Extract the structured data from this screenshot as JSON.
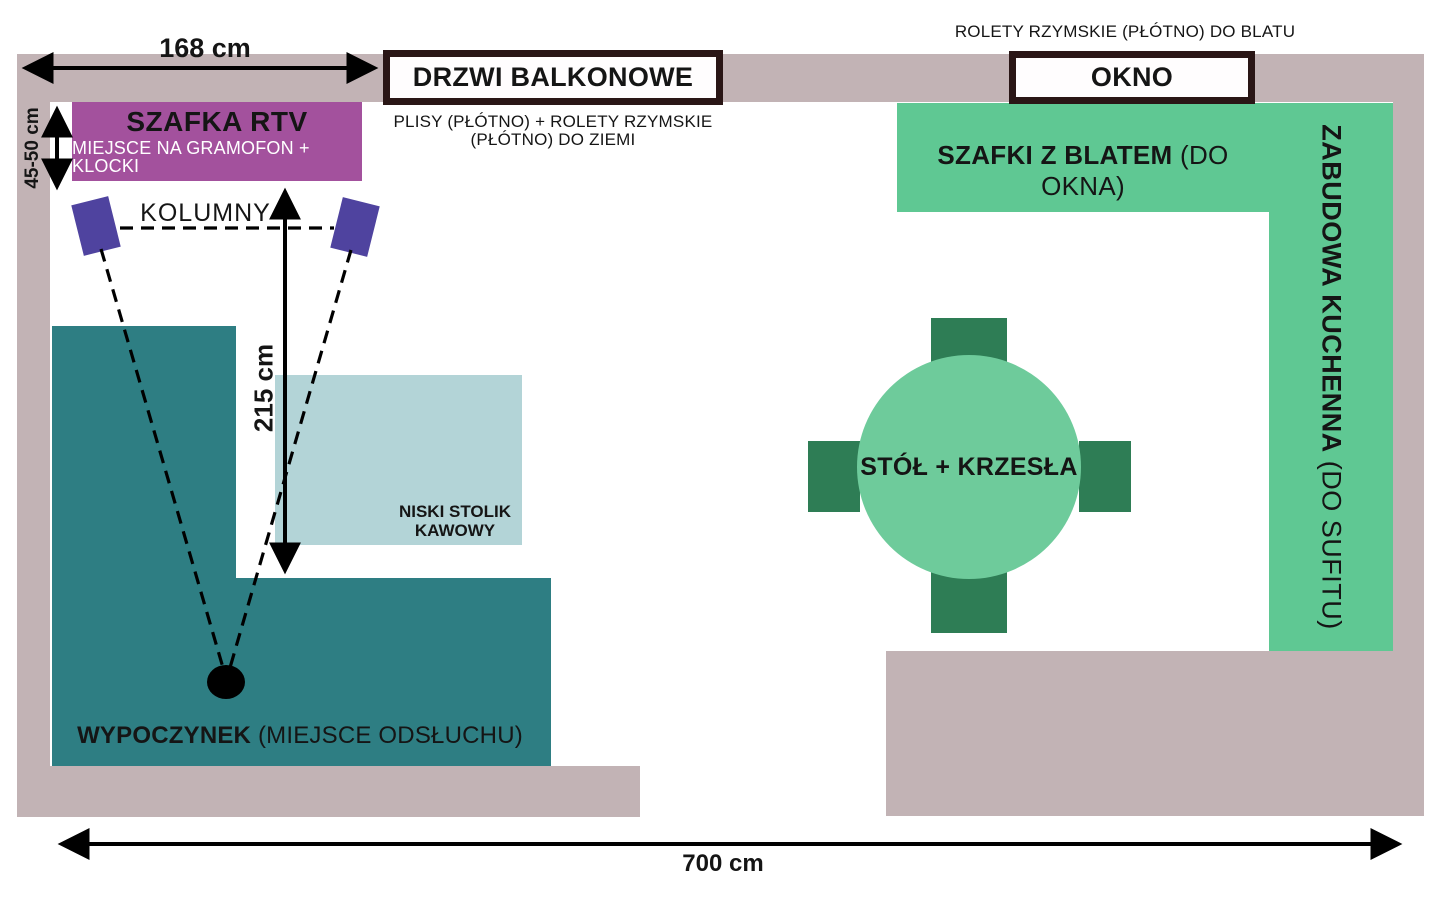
{
  "dimensions": {
    "top_width": "168 cm",
    "rtv_depth": "45-50 cm",
    "listening_distance": "215 cm",
    "room_width": "700 cm"
  },
  "openings": {
    "balcony_door": "DRZWI BALKONOWE",
    "balcony_note_line1": "PLISY (PŁÓTNO) + ROLETY RZYMSKIE",
    "balcony_note_line2": "(PŁÓTNO) DO ZIEMI",
    "window": "OKNO",
    "window_note": "ROLETY RZYMSKIE (PŁÓTNO) DO BLATU"
  },
  "furniture": {
    "rtv_cabinet": {
      "title": "SZAFKA RTV",
      "subtitle": "MIEJSCE NA GRAMOFON + KLOCKI"
    },
    "speakers_label": "KOLUMNY",
    "lounge": {
      "bold": "WYPOCZYNEK",
      "regular": " (MIEJSCE ODSŁUCHU)"
    },
    "coffee_table": {
      "line1": "NISKI STOLIK",
      "line2": "KAWOWY"
    },
    "dining": {
      "label": "STÓŁ + KRZESŁA"
    },
    "kitchen_counter": {
      "bold": "SZAFKI Z BLATEM",
      "regular": " (DO OKNA)"
    },
    "kitchen_tall_unit": {
      "bold": "ZABUDOWA KUCHENNA",
      "regular": " (DO SUFITU)"
    }
  },
  "colors": {
    "wall": "#c2b3b5",
    "lounge_area": "#2e7e83",
    "coffee_table": "#b3d4d7",
    "rtv_cabinet": "#a3519d",
    "speaker": "#4f439f",
    "kitchen_units": "#5fc893",
    "dining_table": "#6ecb9b",
    "chair": "#2e7d55",
    "opening_box_border": "#2a1616",
    "lines": "#000000"
  }
}
